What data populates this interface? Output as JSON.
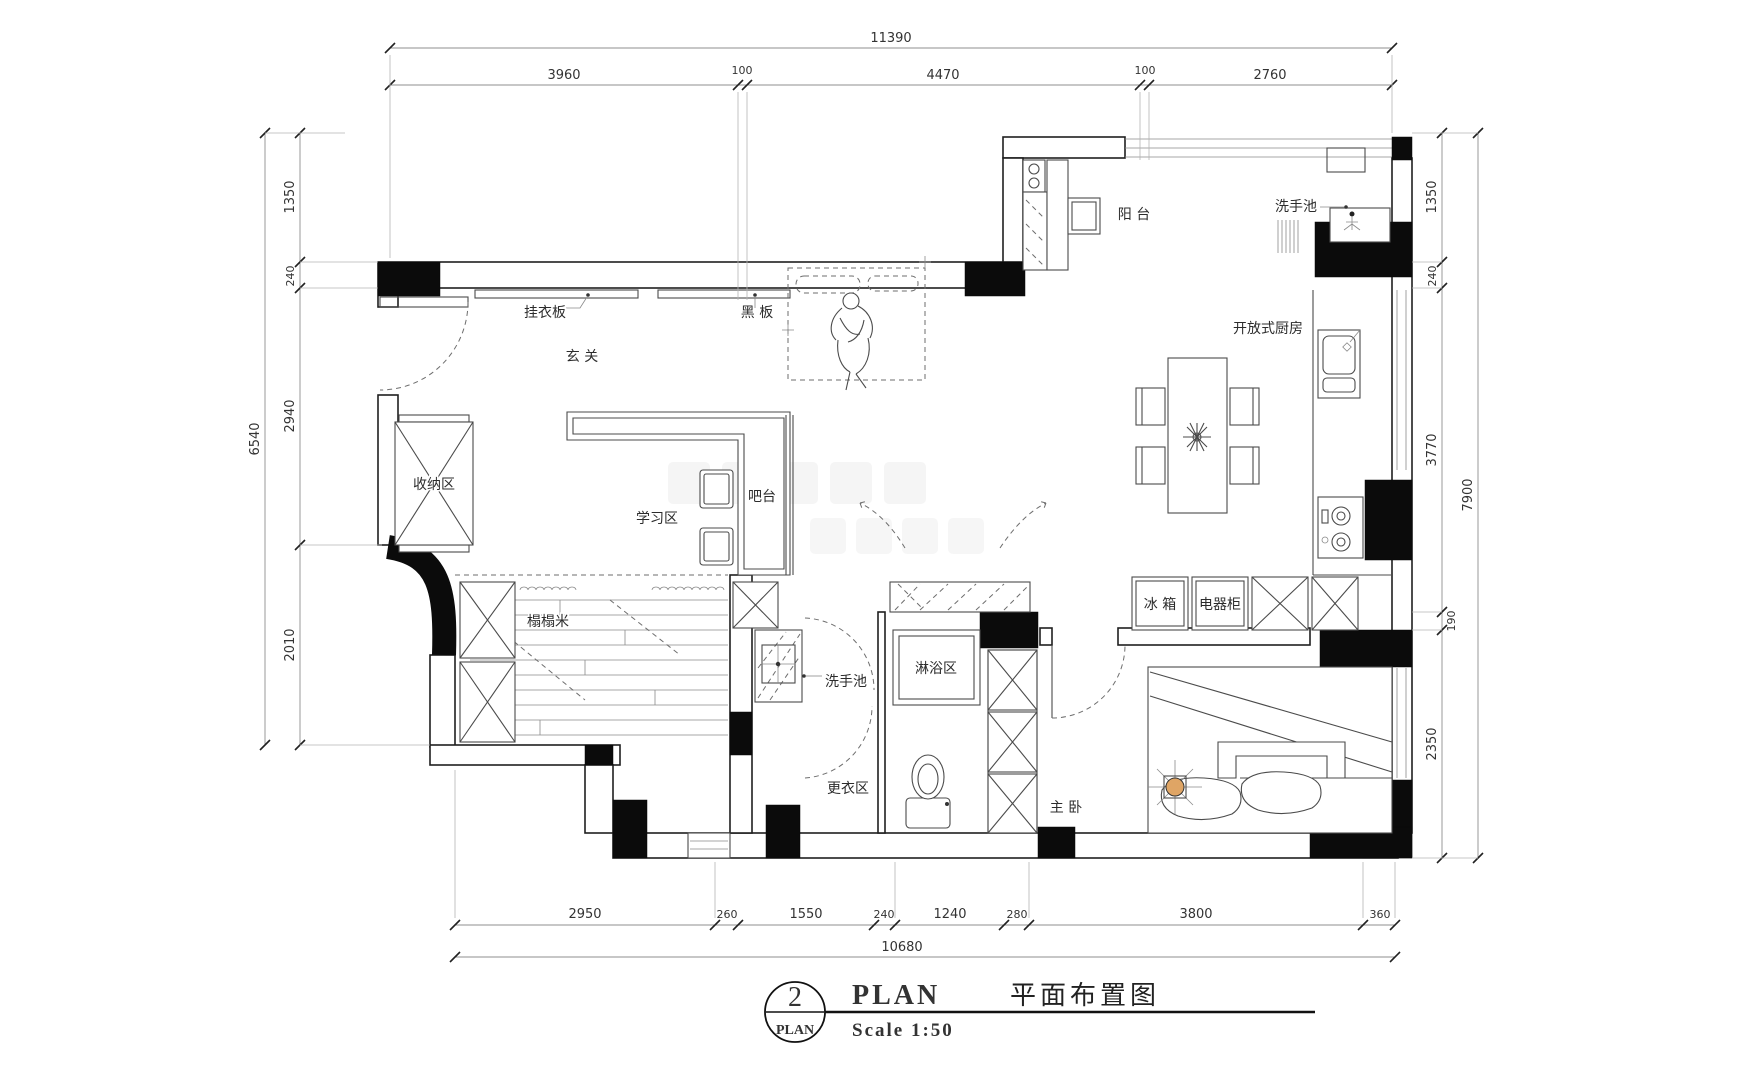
{
  "title_block": {
    "index": "2",
    "index_label": "PLAN",
    "name_en": "PLAN",
    "name_zh": "平面布置图",
    "scale": "Scale  1:50"
  },
  "dimensions": {
    "top": {
      "total": "11390",
      "segments": [
        "3960",
        "100",
        "4470",
        "100",
        "2760"
      ]
    },
    "left": {
      "total": "6540",
      "segments": [
        "1350",
        "240",
        "2940",
        "2010"
      ]
    },
    "right": {
      "total": "7900",
      "segments": [
        "1350",
        "240",
        "3770",
        "190",
        "2350"
      ]
    },
    "bottom": {
      "total": "10680",
      "segments": [
        "2950",
        "260",
        "1550",
        "240",
        "1240",
        "280",
        "3800",
        "360"
      ]
    }
  },
  "labels": {
    "entry": "玄 关",
    "coat_rack": "挂衣板",
    "blackboard": "黑 板",
    "storage": "收纳区",
    "study": "学习区",
    "bar": "吧台",
    "tatami": "榻榻米",
    "balcony": "阳 台",
    "balcony_sink": "洗手池",
    "open_kitchen": "开放式厨房",
    "fridge": "冰 箱",
    "appliance_cabinet": "电器柜",
    "bath_sink": "洗手池",
    "shower": "淋浴区",
    "dressing": "更衣区",
    "master_bedroom": "主 卧"
  },
  "colors": {
    "wall": "#0b0b0b",
    "line": "#4b4b4b",
    "dim": "#8f8f8f",
    "lamp": "#dfa565"
  }
}
